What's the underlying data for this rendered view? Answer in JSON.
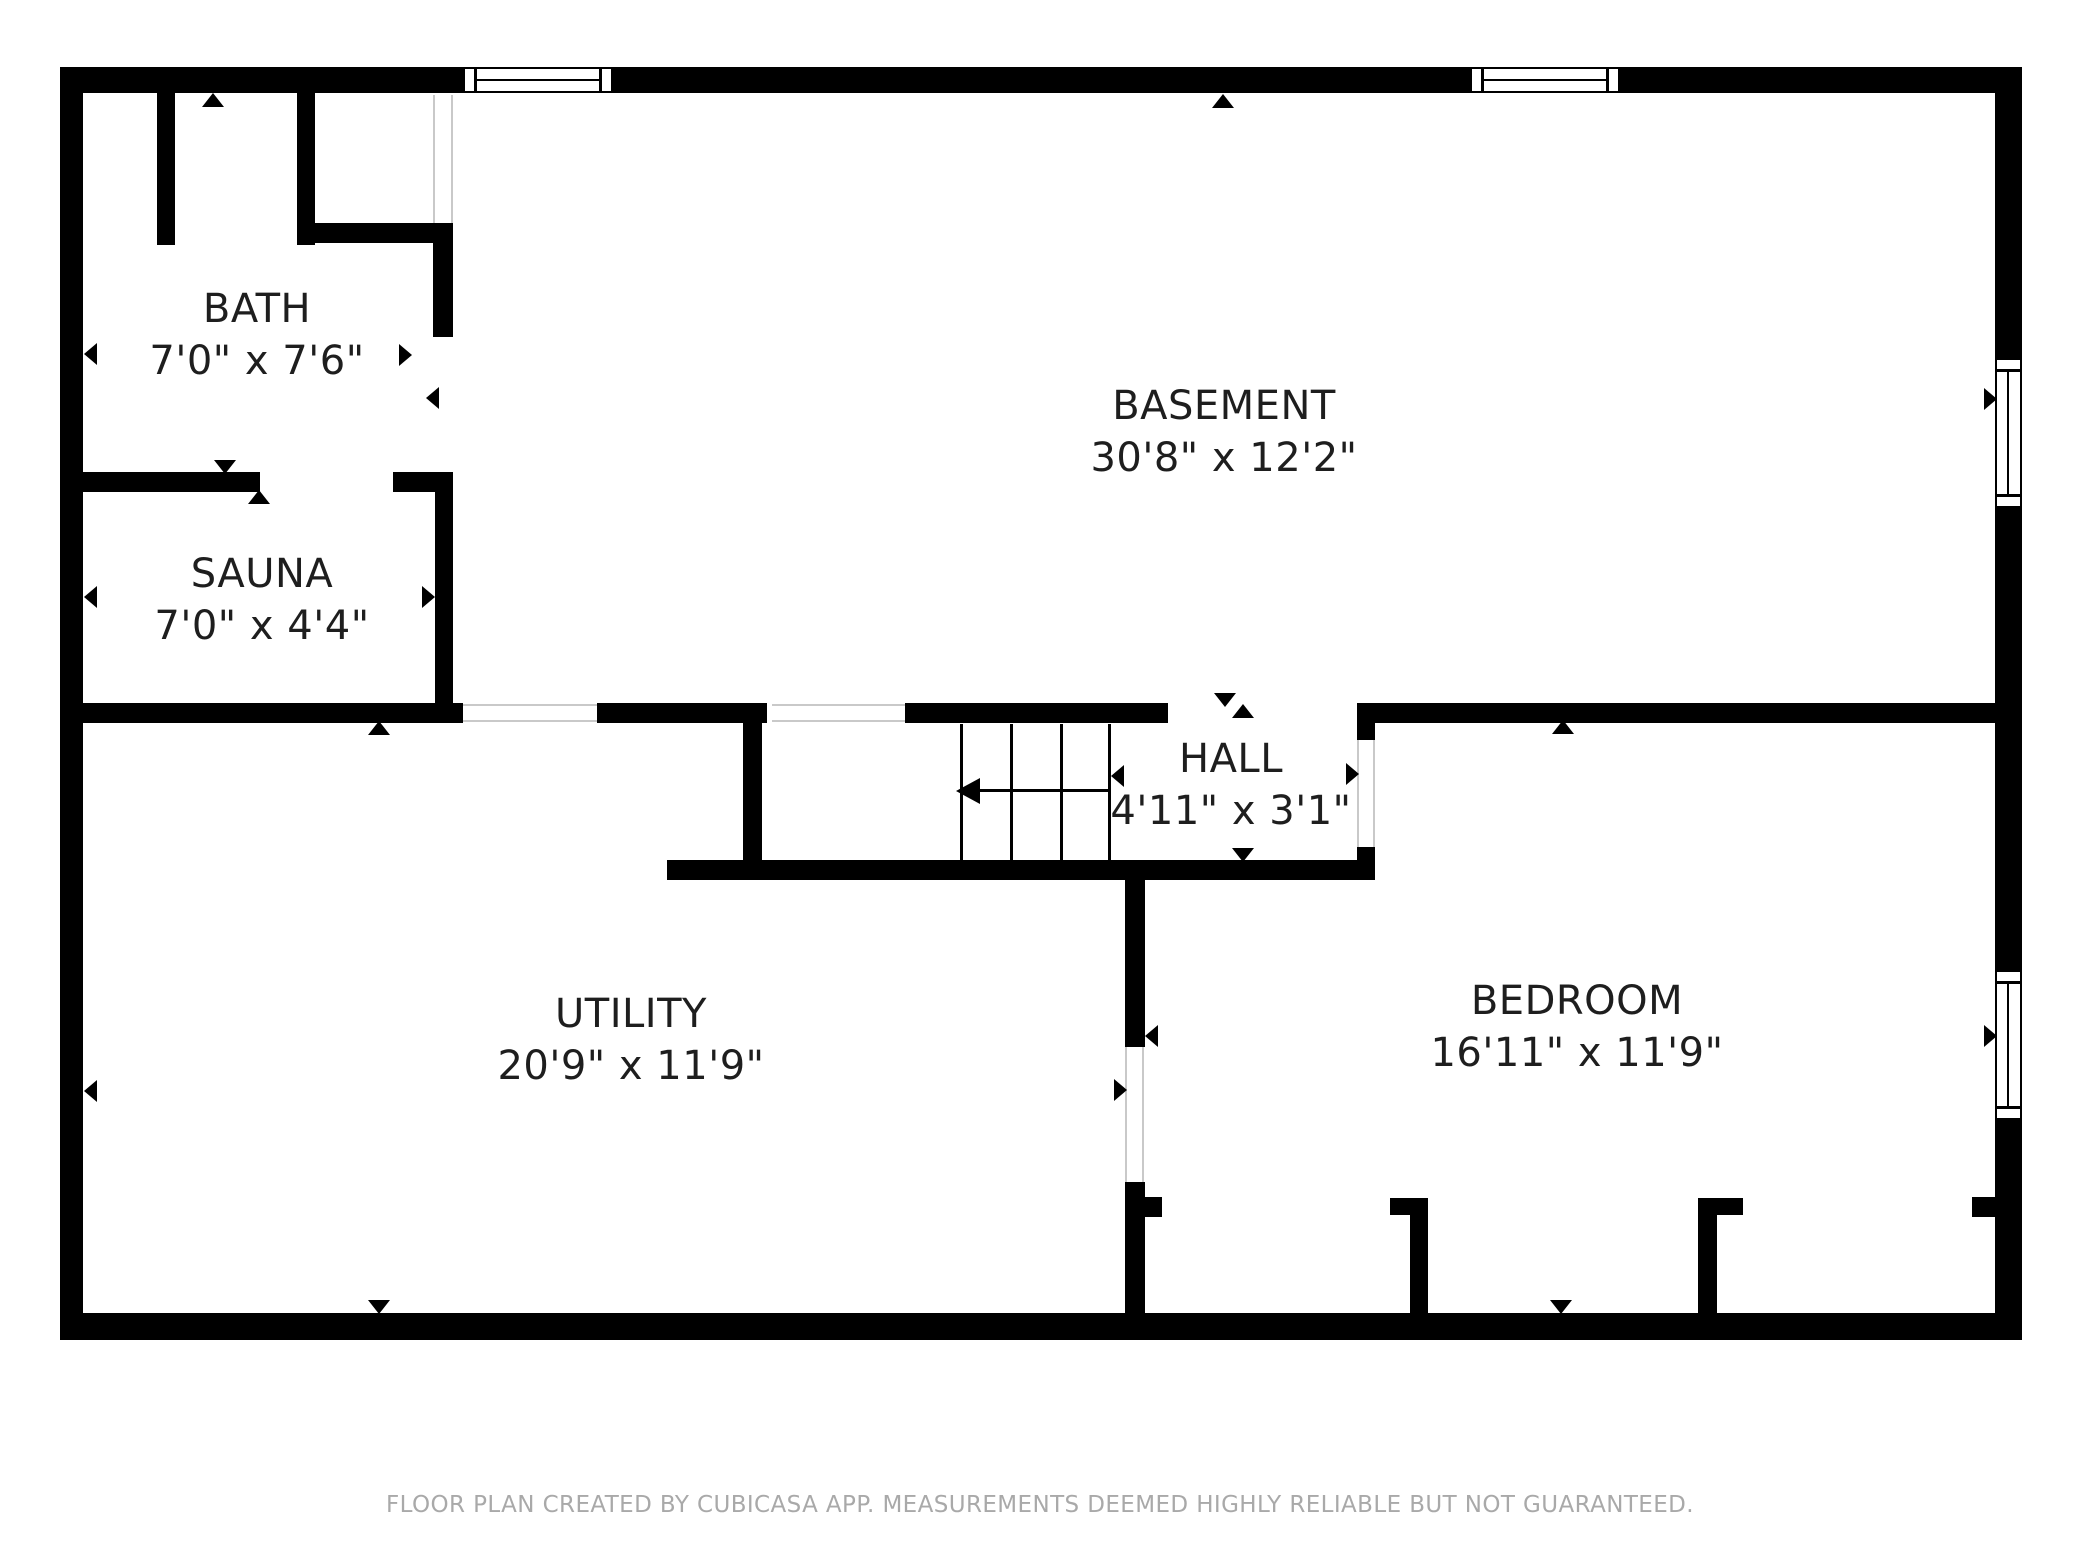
{
  "footer": {
    "text": "FLOOR PLAN CREATED BY CUBICASA APP. MEASUREMENTS DEEMED HIGHLY RELIABLE BUT NOT GUARANTEED.",
    "y": 1492
  },
  "colors": {
    "wall": "#000000",
    "label": "#1e1e1e",
    "footer": "#a9a9a9",
    "door_guide": "#c9c9c9"
  },
  "rooms": [
    {
      "id": "bath",
      "name": "BATH",
      "dims": "7'0\" x 7'6\"",
      "cx": 257,
      "top": 283
    },
    {
      "id": "sauna",
      "name": "SAUNA",
      "dims": "7'0\" x 4'4\"",
      "cx": 262,
      "top": 548
    },
    {
      "id": "basement",
      "name": "BASEMENT",
      "dims": "30'8\" x 12'2\"",
      "cx": 1224,
      "top": 380
    },
    {
      "id": "hall",
      "name": "HALL",
      "dims": "4'11\" x 3'1\"",
      "cx": 1231,
      "top": 733
    },
    {
      "id": "utility",
      "name": "UTILITY",
      "dims": "20'9\" x 11'9\"",
      "cx": 631,
      "top": 988
    },
    {
      "id": "bedroom",
      "name": "BEDROOM",
      "dims": "16'11\" x 11'9\"",
      "cx": 1577,
      "top": 975
    }
  ],
  "walls": [
    {
      "id": "top-1",
      "x": 60,
      "y": 67,
      "w": 403,
      "h": 26
    },
    {
      "id": "top-2",
      "x": 613,
      "y": 67,
      "w": 857,
      "h": 26
    },
    {
      "id": "top-3",
      "x": 1620,
      "y": 67,
      "w": 402,
      "h": 26
    },
    {
      "id": "left-outer",
      "x": 60,
      "y": 67,
      "w": 23,
      "h": 1273
    },
    {
      "id": "right-outer-1",
      "x": 1995,
      "y": 67,
      "w": 27,
      "h": 291
    },
    {
      "id": "right-outer-2",
      "x": 1995,
      "y": 508,
      "w": 27,
      "h": 462
    },
    {
      "id": "right-outer-3",
      "x": 1995,
      "y": 1120,
      "w": 27,
      "h": 220
    },
    {
      "id": "bottom-outer",
      "x": 60,
      "y": 1313,
      "w": 1962,
      "h": 27
    },
    {
      "id": "bath-closet-left",
      "x": 157,
      "y": 93,
      "w": 18,
      "h": 152
    },
    {
      "id": "bath-closet-right",
      "x": 297,
      "y": 93,
      "w": 18,
      "h": 152
    },
    {
      "id": "bath-nook",
      "x": 315,
      "y": 223,
      "w": 138,
      "h": 20
    },
    {
      "id": "bath-basement-div",
      "x": 433,
      "y": 223,
      "w": 20,
      "h": 114
    },
    {
      "id": "sauna-top-1",
      "x": 83,
      "y": 472,
      "w": 177,
      "h": 20
    },
    {
      "id": "sauna-top-2",
      "x": 393,
      "y": 472,
      "w": 60,
      "h": 20
    },
    {
      "id": "sauna-right",
      "x": 435,
      "y": 472,
      "w": 18,
      "h": 231
    },
    {
      "id": "mid-div-1",
      "x": 60,
      "y": 703,
      "w": 403,
      "h": 20
    },
    {
      "id": "mid-div-2",
      "x": 597,
      "y": 703,
      "w": 170,
      "h": 20
    },
    {
      "id": "mid-div-3",
      "x": 905,
      "y": 703,
      "w": 263,
      "h": 20
    },
    {
      "id": "bedroom-top",
      "x": 1357,
      "y": 703,
      "w": 638,
      "h": 20
    },
    {
      "id": "stair-left-wall",
      "x": 743,
      "y": 703,
      "w": 19,
      "h": 175
    },
    {
      "id": "hall-bottom",
      "x": 667,
      "y": 860,
      "w": 708,
      "h": 20
    },
    {
      "id": "hall-right-1",
      "x": 1357,
      "y": 703,
      "w": 18,
      "h": 37
    },
    {
      "id": "hall-right-2",
      "x": 1357,
      "y": 847,
      "w": 18,
      "h": 33
    },
    {
      "id": "util-bed-div-1",
      "x": 1125,
      "y": 880,
      "w": 20,
      "h": 167
    },
    {
      "id": "util-bed-div-2",
      "x": 1125,
      "y": 1182,
      "w": 20,
      "h": 131
    },
    {
      "id": "util-bed-nub",
      "x": 1143,
      "y": 1197,
      "w": 19,
      "h": 20
    },
    {
      "id": "closet1-col",
      "x": 1410,
      "y": 1198,
      "w": 18,
      "h": 115
    },
    {
      "id": "closet1-nub",
      "x": 1390,
      "y": 1198,
      "w": 38,
      "h": 17
    },
    {
      "id": "closet2-col",
      "x": 1698,
      "y": 1198,
      "w": 19,
      "h": 115
    },
    {
      "id": "closet2-nub",
      "x": 1698,
      "y": 1198,
      "w": 45,
      "h": 17
    },
    {
      "id": "right-closet-nub",
      "x": 1972,
      "y": 1197,
      "w": 23,
      "h": 20
    }
  ],
  "door_guides": [
    {
      "x": 433,
      "y": 95,
      "w": 2,
      "h": 128
    },
    {
      "x": 451,
      "y": 95,
      "w": 2,
      "h": 128
    },
    {
      "x": 1125,
      "y": 1047,
      "w": 2,
      "h": 135
    },
    {
      "x": 1142,
      "y": 1047,
      "w": 2,
      "h": 135
    },
    {
      "x": 1357,
      "y": 740,
      "w": 2,
      "h": 107
    },
    {
      "x": 1373,
      "y": 740,
      "w": 2,
      "h": 107
    },
    {
      "x": 772,
      "y": 704,
      "w": 133,
      "h": 2
    },
    {
      "x": 772,
      "y": 720,
      "w": 133,
      "h": 2
    },
    {
      "x": 463,
      "y": 704,
      "w": 134,
      "h": 2
    },
    {
      "x": 463,
      "y": 720,
      "w": 134,
      "h": 2
    }
  ],
  "windows": [
    {
      "id": "top-window-left",
      "orient": "h",
      "x": 463,
      "y": 67,
      "w": 150,
      "h": 26
    },
    {
      "id": "top-window-right",
      "orient": "h",
      "x": 1470,
      "y": 67,
      "w": 150,
      "h": 26
    },
    {
      "id": "right-window-basement",
      "orient": "v",
      "x": 1995,
      "y": 358,
      "w": 27,
      "h": 150
    },
    {
      "id": "right-window-bedroom",
      "orient": "v",
      "x": 1995,
      "y": 970,
      "w": 27,
      "h": 150
    }
  ],
  "stairs": {
    "lines": [
      {
        "x": 960,
        "y": 724,
        "w": 3,
        "h": 136
      },
      {
        "x": 1010,
        "y": 724,
        "w": 3,
        "h": 136
      },
      {
        "x": 1060,
        "y": 724,
        "w": 3,
        "h": 136
      },
      {
        "x": 1108,
        "y": 724,
        "w": 3,
        "h": 136
      },
      {
        "x": 978,
        "y": 789,
        "w": 132,
        "h": 3
      }
    ],
    "arrowhead": {
      "x": 956,
      "y": 778
    }
  },
  "arrows": [
    {
      "x": 202,
      "y": 93,
      "dir": "up"
    },
    {
      "x": 1212,
      "y": 94,
      "dir": "up"
    },
    {
      "x": 84,
      "y": 343,
      "dir": "left"
    },
    {
      "x": 399,
      "y": 344,
      "dir": "right"
    },
    {
      "x": 426,
      "y": 387,
      "dir": "left"
    },
    {
      "x": 214,
      "y": 460,
      "dir": "down"
    },
    {
      "x": 248,
      "y": 490,
      "dir": "up"
    },
    {
      "x": 84,
      "y": 586,
      "dir": "left"
    },
    {
      "x": 422,
      "y": 586,
      "dir": "right"
    },
    {
      "x": 368,
      "y": 721,
      "dir": "up"
    },
    {
      "x": 1214,
      "y": 693,
      "dir": "down"
    },
    {
      "x": 1232,
      "y": 704,
      "dir": "up"
    },
    {
      "x": 1346,
      "y": 763,
      "dir": "right"
    },
    {
      "x": 1111,
      "y": 765,
      "dir": "left"
    },
    {
      "x": 1232,
      "y": 848,
      "dir": "down"
    },
    {
      "x": 1552,
      "y": 720,
      "dir": "up"
    },
    {
      "x": 1145,
      "y": 1025,
      "dir": "left"
    },
    {
      "x": 1114,
      "y": 1079,
      "dir": "right"
    },
    {
      "x": 84,
      "y": 1080,
      "dir": "left"
    },
    {
      "x": 1984,
      "y": 388,
      "dir": "right"
    },
    {
      "x": 1984,
      "y": 1025,
      "dir": "right"
    },
    {
      "x": 368,
      "y": 1300,
      "dir": "down"
    },
    {
      "x": 1550,
      "y": 1300,
      "dir": "down"
    }
  ]
}
